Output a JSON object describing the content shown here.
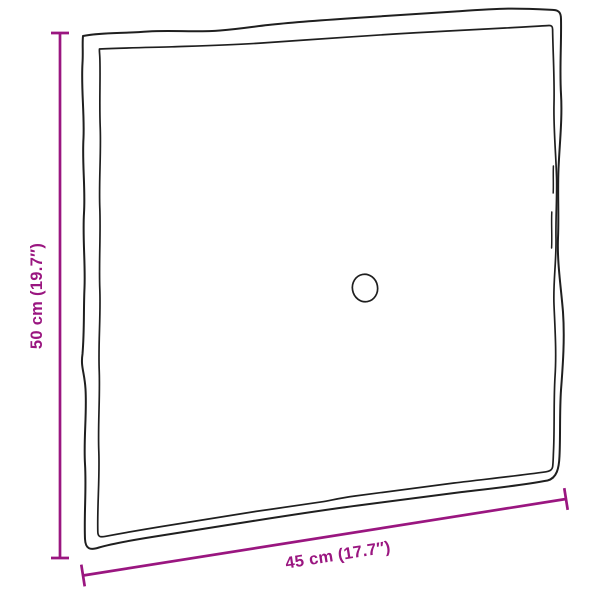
{
  "colors": {
    "accent": "#9A1680",
    "outline": "#1f1f1f",
    "background": "#ffffff"
  },
  "diagram": {
    "type": "product-dimension-diagram",
    "subject": "square cushion top view with center button, hand-drawn outline",
    "dimensions": {
      "height": {
        "value_cm": "50",
        "value_in": "19.7",
        "label": "50 cm (19.7″)"
      },
      "width": {
        "value_cm": "45",
        "value_in": "17.7",
        "label": "45 cm (17.7″)"
      }
    }
  }
}
